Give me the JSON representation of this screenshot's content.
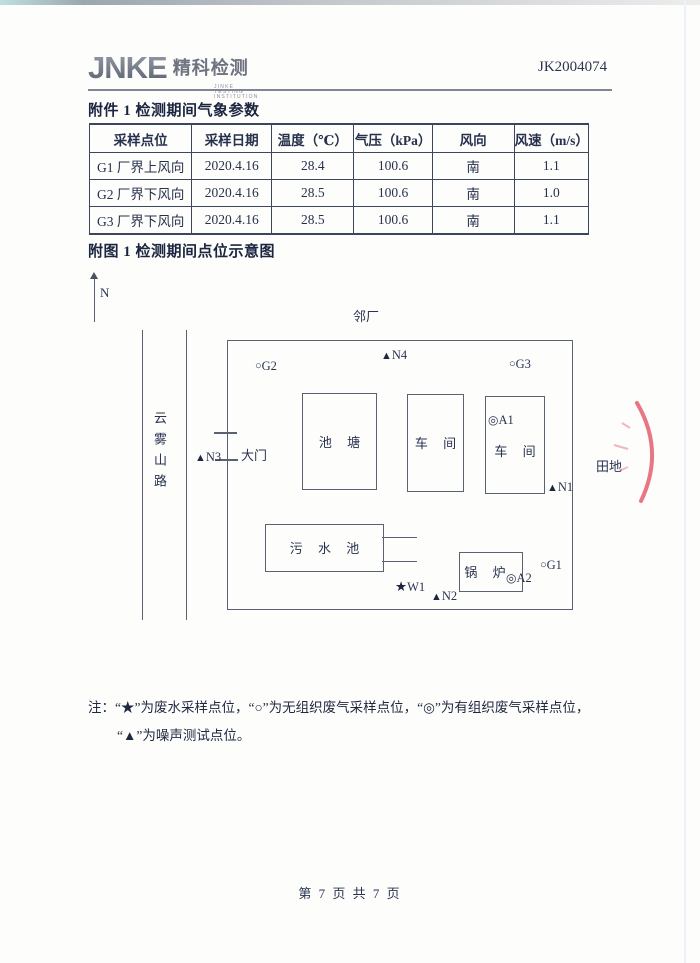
{
  "page": {
    "report_no": "JK2004074",
    "footer": "第 7 页 共 7 页"
  },
  "logo": {
    "brand": "JNKE",
    "brand_cn": "精科检测",
    "subtitle": "JINKE TESTING INSTITUTION"
  },
  "attachment1": {
    "title": "附件 1  检测期间气象参数",
    "table": {
      "headers": [
        "采样点位",
        "采样日期",
        "温度（℃）",
        "气压（kPa）",
        "风向",
        "风速（m/s）"
      ],
      "rows": [
        [
          "G1 厂界上风向",
          "2020.4.16",
          "28.4",
          "100.6",
          "南",
          "1.1"
        ],
        [
          "G2 厂界下风向",
          "2020.4.16",
          "28.5",
          "100.6",
          "南",
          "1.0"
        ],
        [
          "G3 厂界下风向",
          "2020.4.16",
          "28.5",
          "100.6",
          "南",
          "1.1"
        ]
      ]
    }
  },
  "figure1": {
    "title": "附图 1  检测期间点位示意图",
    "labels": {
      "north": "N",
      "neighbor_factory": "邻厂",
      "road": "云雾山路",
      "gate": "大门",
      "field": "田地"
    },
    "buildings": {
      "pond": "池 塘",
      "workshop_top": "车 间",
      "workshop_right": "车 间",
      "sewage_pool": "污 水 池",
      "boiler": "锅 炉"
    },
    "points": {
      "G2": {
        "symbol": "○",
        "label": "G2"
      },
      "N4": {
        "symbol": "▲",
        "label": "N4"
      },
      "G3": {
        "symbol": "○",
        "label": "G3"
      },
      "N3": {
        "symbol": "▲",
        "label": "N3"
      },
      "A1": {
        "symbol": "◎",
        "label": "A1"
      },
      "N1": {
        "symbol": "▲",
        "label": "N1"
      },
      "W1": {
        "symbol": "★",
        "label": "W1"
      },
      "N2": {
        "symbol": "▲",
        "label": "N2"
      },
      "A2": {
        "symbol": "◎",
        "label": "A2"
      },
      "G1": {
        "symbol": "○",
        "label": "G1"
      }
    }
  },
  "note": {
    "line1": "注：“★”为废水采样点位，“○”为无组织废气采样点位，“◎”为有组织废气采样点位，",
    "line2": "“▲”为噪声测试点位。"
  }
}
